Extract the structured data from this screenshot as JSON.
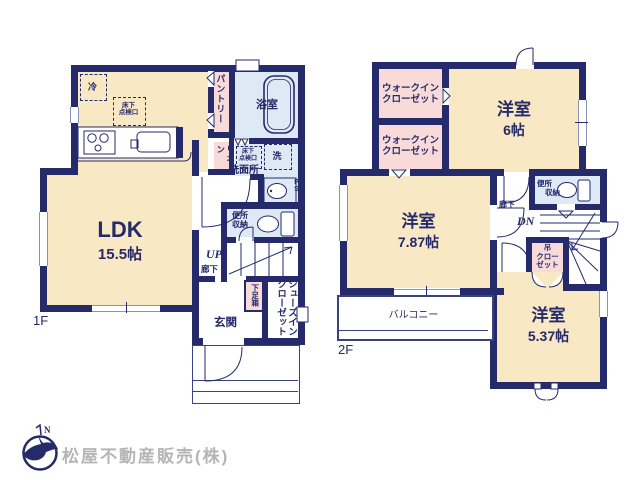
{
  "company": {
    "name": "松屋不動産販売(株)",
    "logo_n": "N"
  },
  "floor1": {
    "label": "1F",
    "ldk": "LDK",
    "ldk_size": "15.5帖",
    "fridge": "冷",
    "underfloor_line1": "床下",
    "underfloor_line2": "点検口",
    "pantry": "パントリー",
    "bath": "浴室",
    "linen": "リネン",
    "underfloor2_line1": "床下",
    "underfloor2_line2": "点検口",
    "washer": "洗",
    "washroom": "洗面所",
    "ds": "DS",
    "ps": "PS",
    "toilet_line1": "便所",
    "toilet_line2": "収納",
    "up": "UP",
    "hall": "廊下",
    "shoebox": "下足箱",
    "sic_line1": "シューズイン",
    "sic_line2": "クローゼット",
    "genkan": "玄関"
  },
  "floor2": {
    "label": "2F",
    "wic1_line1": "ウォークイン",
    "wic1_line2": "クローゼット",
    "wic2_line1": "ウォークイン",
    "wic2_line2": "クローゼット",
    "room6": "洋室",
    "room6_size": "6帖",
    "room787": "洋室",
    "room787_size": "7.87帖",
    "room537": "洋室",
    "room537_size": "5.37帖",
    "hall": "廊下",
    "dn": "DN",
    "toilet_line1": "便所",
    "toilet_line2": "収納",
    "closet_line1": "吊",
    "closet_line2": "クロー",
    "closet_line3": "ゼット",
    "balcony": "バルコニー"
  },
  "colors": {
    "wall": "#252a6b",
    "room": "#f9e8c4",
    "wet": "#dde9f4",
    "pink": "#f8dbd8",
    "company_text": "#b5b5b6"
  }
}
